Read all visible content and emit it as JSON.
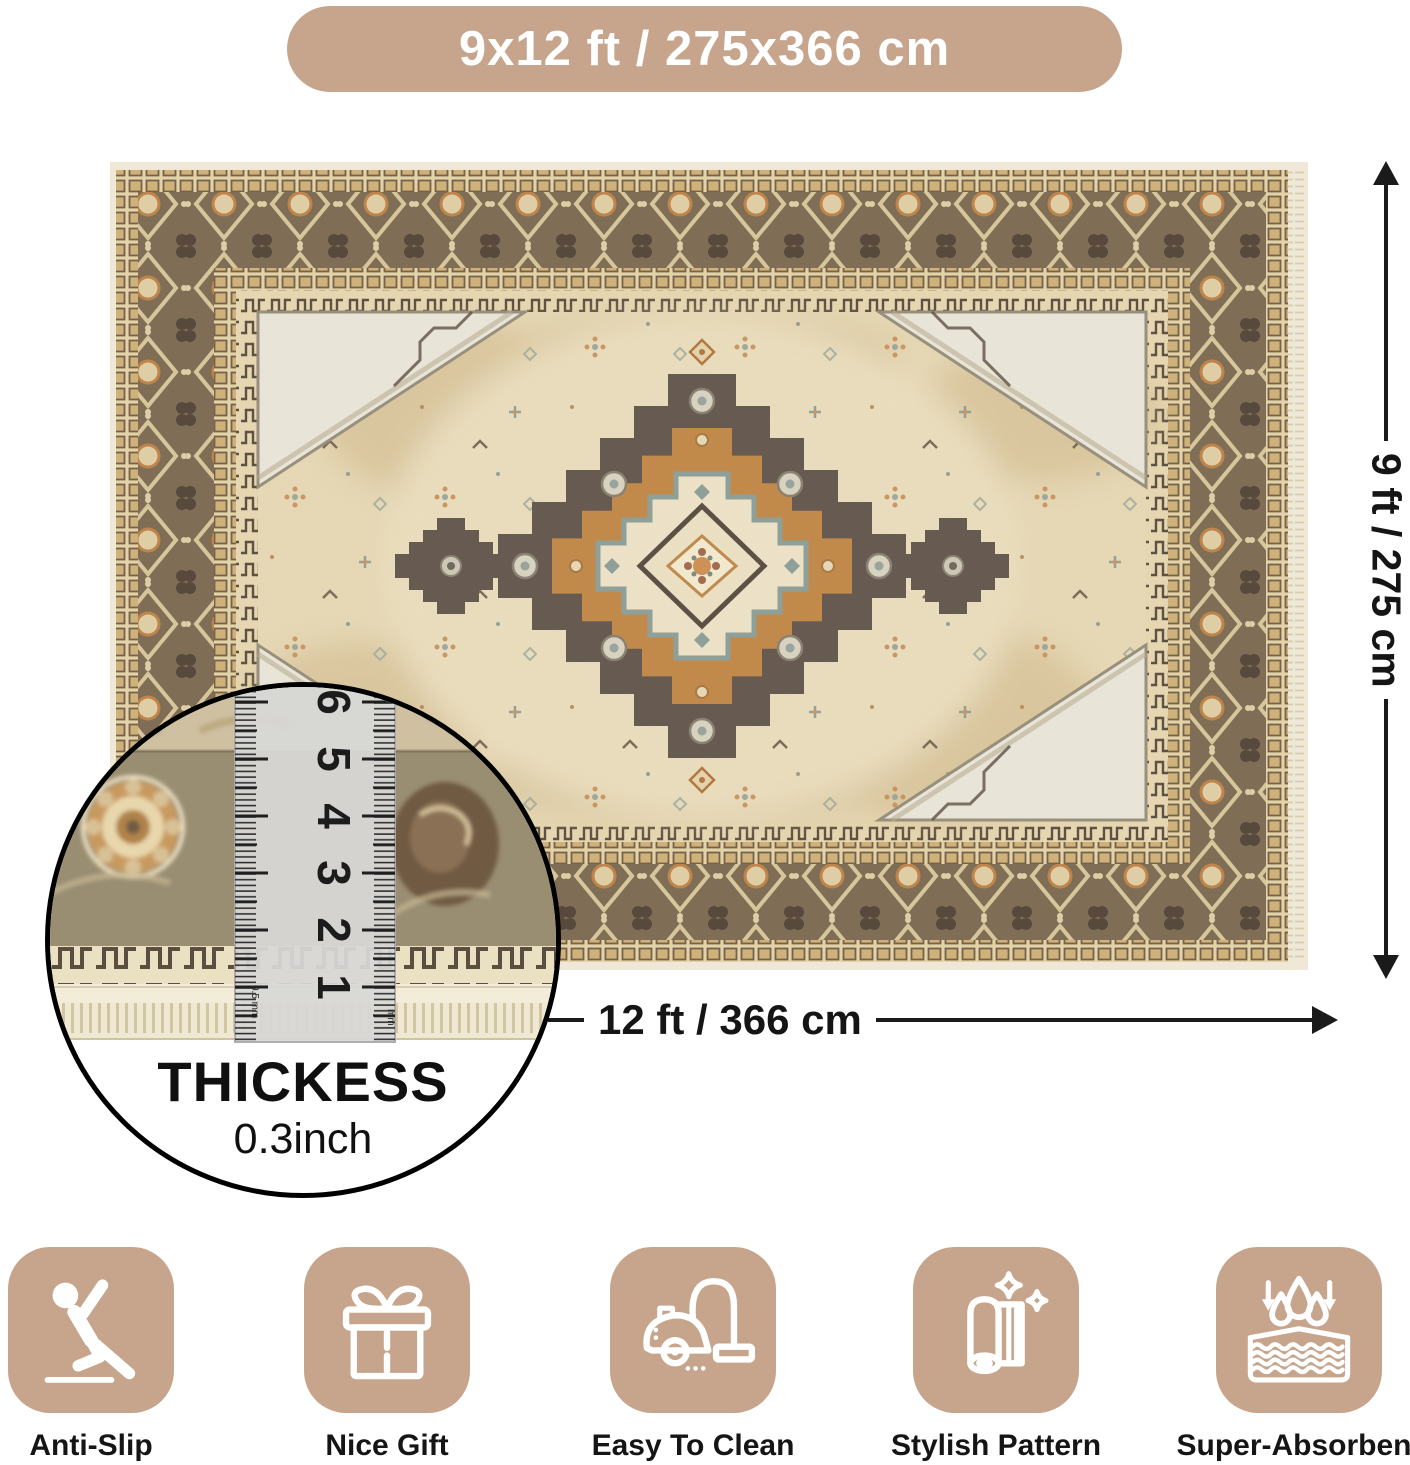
{
  "size_badge": {
    "label": "9x12 ft / 275x366 cm"
  },
  "dimensions": {
    "height_label": "9 ft / 275 cm",
    "width_label": "12 ft / 366 cm"
  },
  "thickness": {
    "title": "THICKESS",
    "value": "0.3inch",
    "ruler_numbers": [
      "1",
      "2",
      "3",
      "4",
      "5",
      "6"
    ],
    "ruler_left_unit": "0.5 mm",
    "ruler_right_unit": "mm"
  },
  "features": [
    {
      "label": "Anti-Slip",
      "icon": "anti-slip-icon"
    },
    {
      "label": "Nice Gift",
      "icon": "gift-icon"
    },
    {
      "label": "Easy To Clean",
      "icon": "vacuum-icon"
    },
    {
      "label": "Stylish Pattern",
      "icon": "rolled-rug-icon"
    },
    {
      "label": "Super-Absorbent",
      "icon": "water-drops-icon"
    }
  ],
  "colors": {
    "tan": "#c6a58c",
    "ink": "#151515",
    "arrow": "#1a1a1a",
    "rug-edge": "#f1ead9",
    "box-bg": "#e5d4a9",
    "box-square": "#d0b27a",
    "box-line": "#756049",
    "band-brown": "#7e6c55",
    "band-motif": "#d9c79c",
    "crenel-bg": "#e7d8b2",
    "crenel-line": "#5d4f41",
    "field": "#e7d9b6",
    "abrash": "#c9ae7e",
    "medallion-dark": "#655950",
    "medallion-orange": "#c28a4a",
    "ivory": "#eee3c8",
    "teal": "#8ea09a",
    "spandrel": "#eae6da",
    "spandrel-line": "#98907d"
  }
}
